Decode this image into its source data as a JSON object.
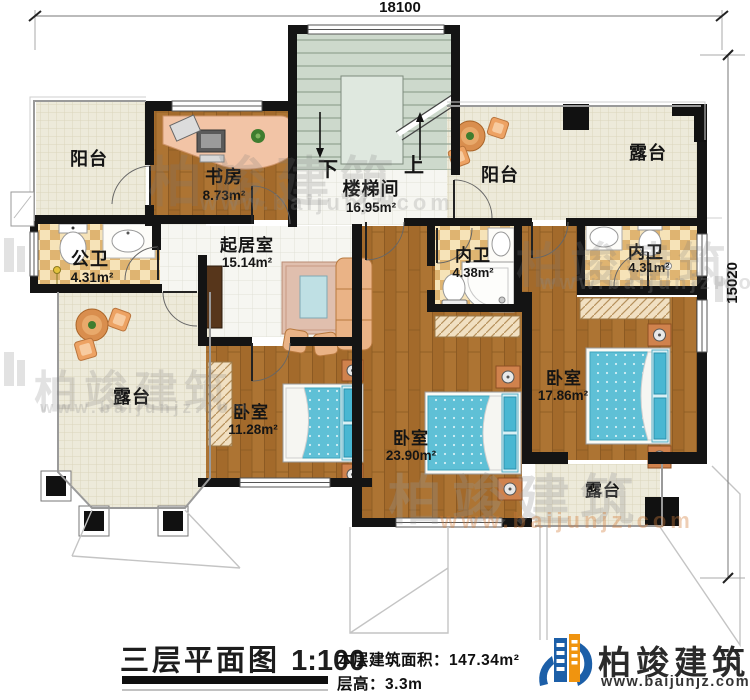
{
  "dimensions": {
    "top": "18100",
    "right": "15020"
  },
  "rooms": {
    "balcony_tl": {
      "name": "阳台"
    },
    "study": {
      "name": "书房",
      "area": "8.73m²"
    },
    "stairwell": {
      "name": "楼梯间",
      "area": "16.95m²",
      "down": "下",
      "up": "上"
    },
    "balcony_tr": {
      "name": "阳台"
    },
    "terrace_tr": {
      "name": "露台"
    },
    "public_bath": {
      "name": "公卫",
      "area": "4.31m²"
    },
    "living": {
      "name": "起居室",
      "area": "15.14m²"
    },
    "ensuite_1": {
      "name": "内卫",
      "area": "4.38m²"
    },
    "ensuite_2": {
      "name": "内卫",
      "area": "4.31m²"
    },
    "terrace_left": {
      "name": "露台"
    },
    "bedroom_1": {
      "name": "卧室",
      "area": "11.28m²"
    },
    "bedroom_2": {
      "name": "卧室",
      "area": "23.90m²"
    },
    "bedroom_3": {
      "name": "卧室",
      "area": "17.86m²"
    },
    "terrace_br": {
      "name": "露台"
    }
  },
  "title_block": {
    "title": "三层平面图",
    "scale": "1:100",
    "area_label": "本层建筑面积：",
    "area_value": "147.34m²",
    "floor_height_label": "层高：",
    "floor_height_value": "3.3m"
  },
  "logo": {
    "name": "柏竣建筑",
    "url": "www.baijunjz.com"
  },
  "watermark": {
    "name": "柏竣建筑",
    "url": "www.baijunjz.com"
  }
}
